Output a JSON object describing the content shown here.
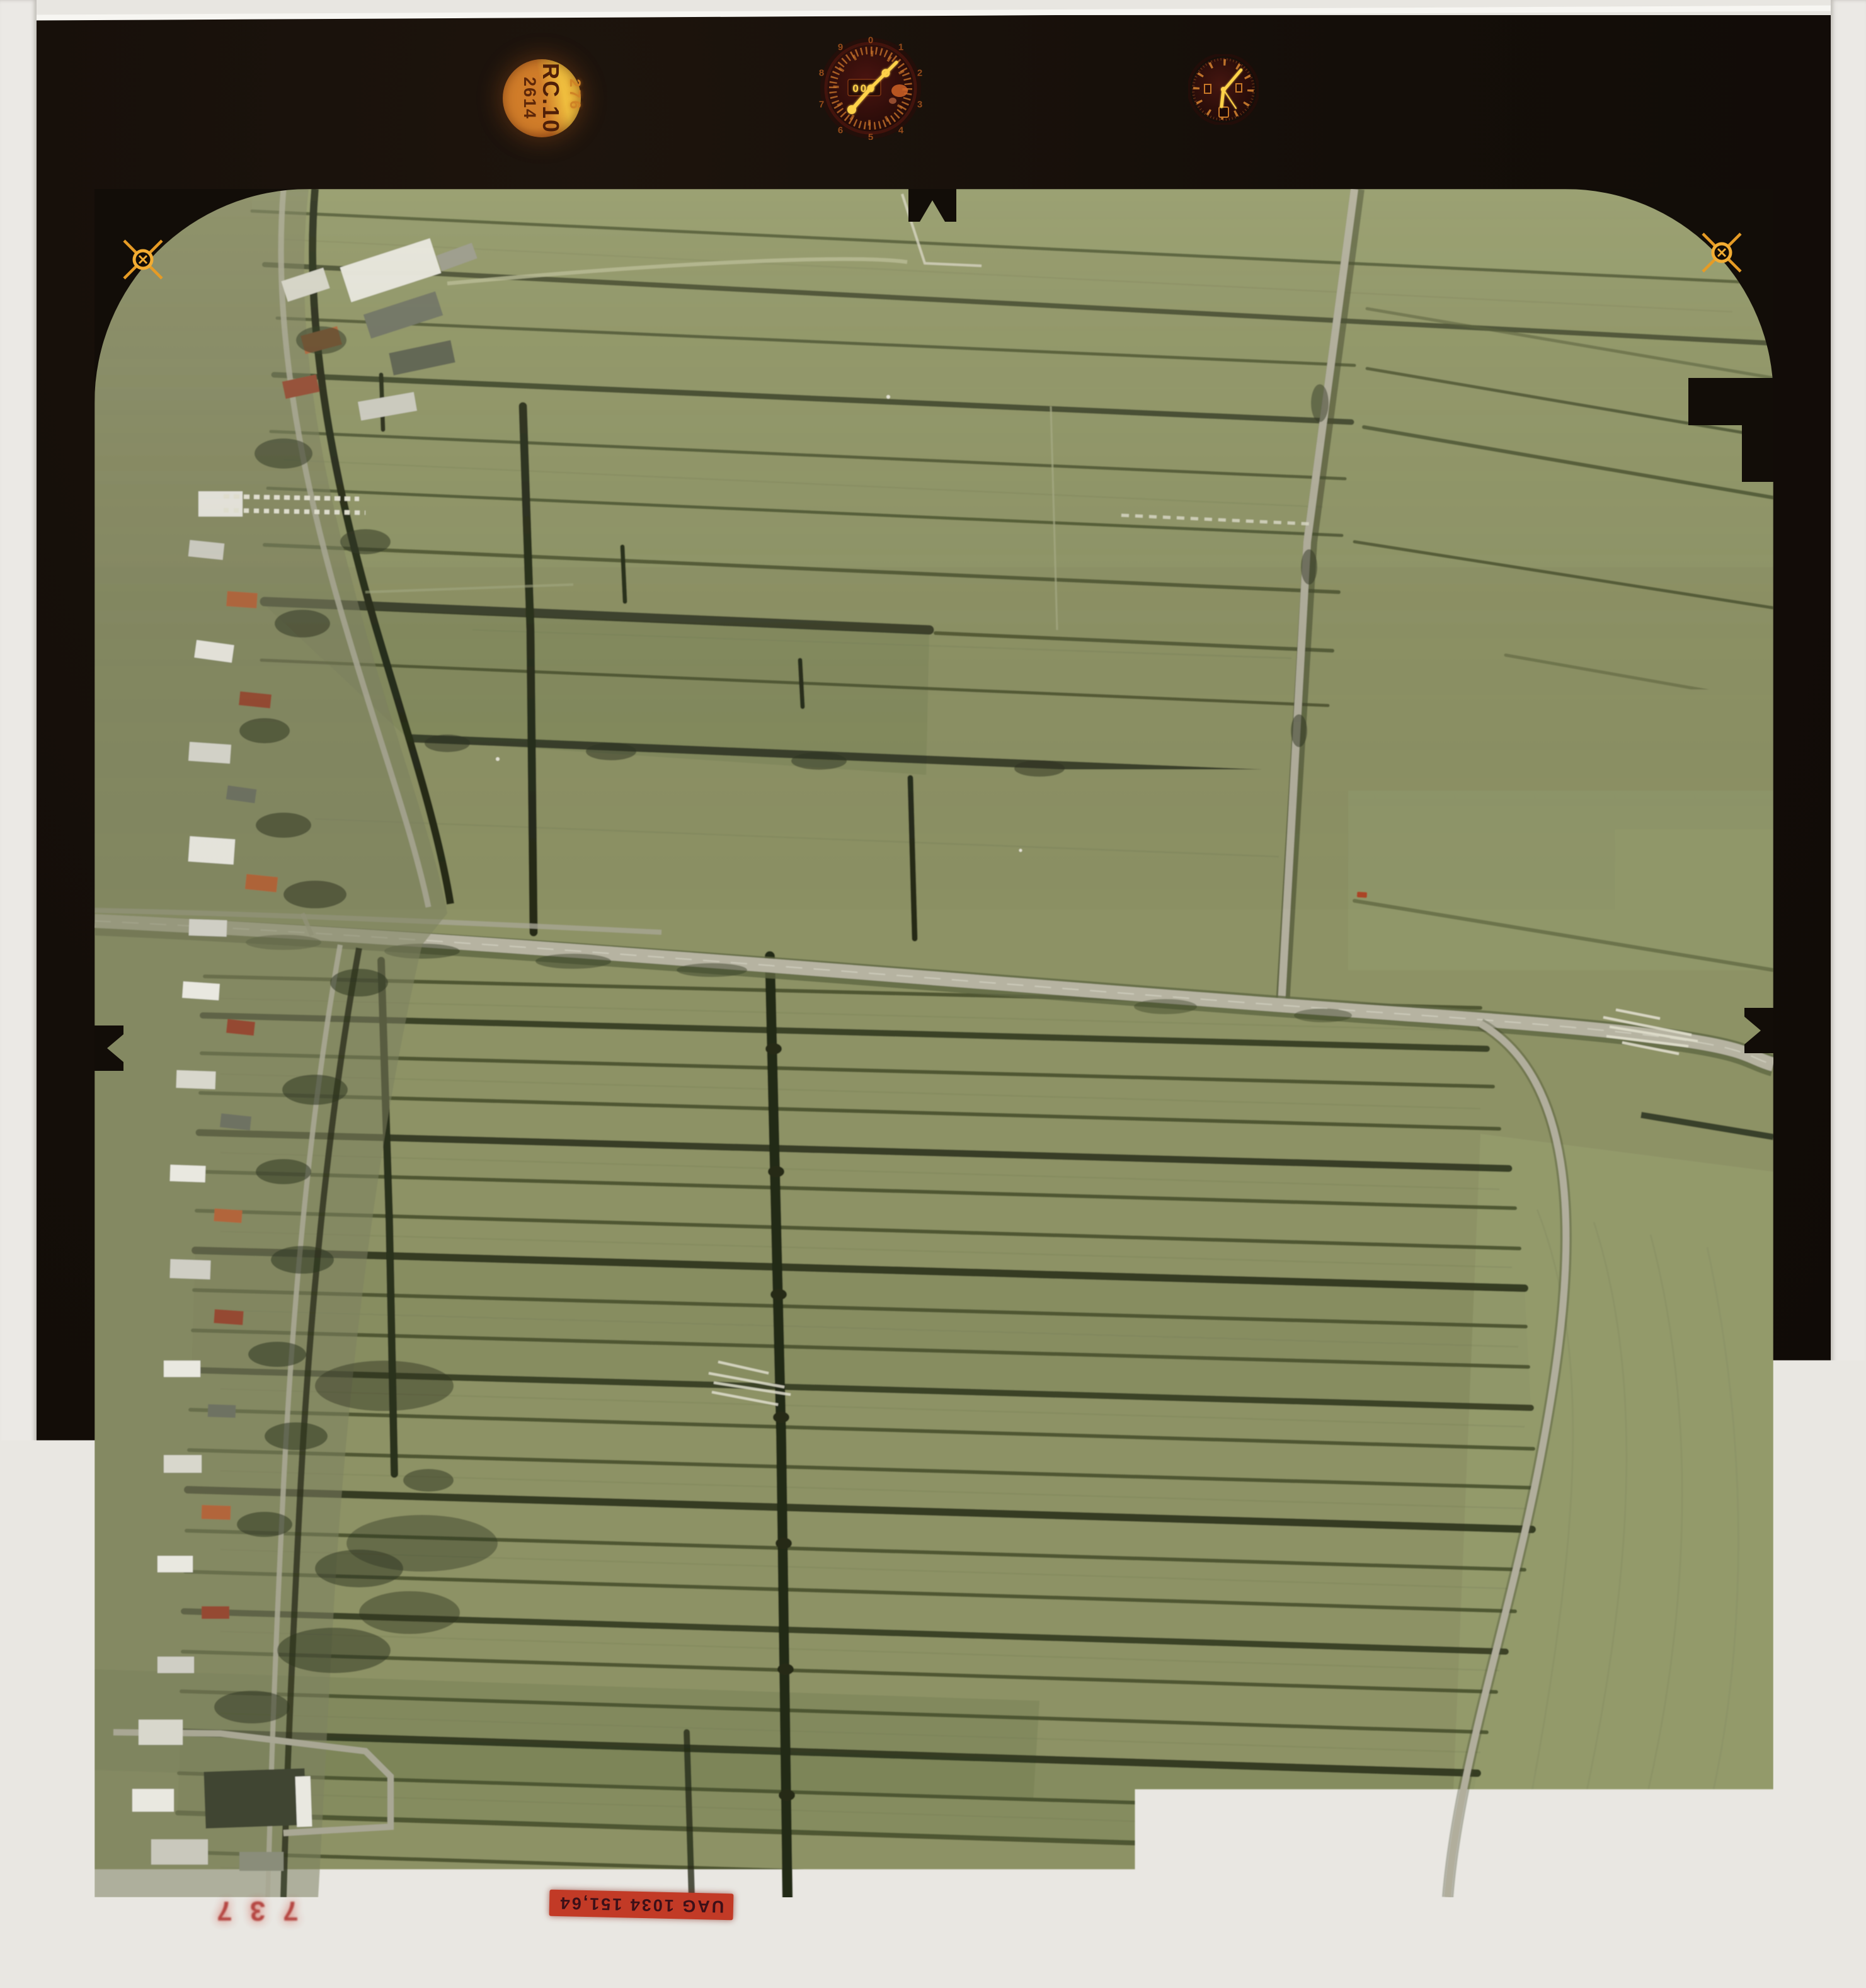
{
  "badge": {
    "model": "RC.10",
    "serial": "2614",
    "aux_number": "276"
  },
  "altimeter": {
    "window_digits": "000",
    "numerals": [
      "0",
      "1",
      "2",
      "3",
      "4",
      "5",
      "6",
      "7",
      "8",
      "9"
    ]
  },
  "footer": {
    "photo_id": "UAG 1034 151,64",
    "frame_counter": "737"
  },
  "fiducial_marks": {
    "count": 4,
    "positions": [
      "top-left",
      "top-right",
      "bottom-left",
      "bottom-right"
    ]
  },
  "colors": {
    "film_border": "#120d08",
    "field_green": "#8d9265",
    "ditch_dark": "#333a22",
    "road_light": "#b6b3a1",
    "fiducial_orange": "#f3ad33",
    "badge_orange": "#c06a28",
    "badge_yellow": "#e2a62e",
    "label_red": "#c23a26",
    "dial_tick_orange": "#c4702a",
    "hand_yellow": "#ffd24a",
    "counter_red": "#a81e1a"
  }
}
